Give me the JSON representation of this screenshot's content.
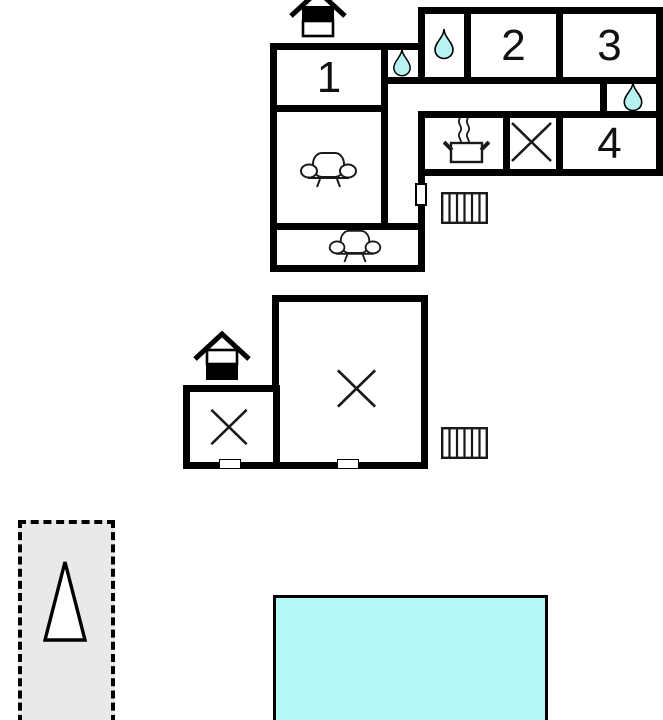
{
  "upper_floor": {
    "room_labels": {
      "r1": "1",
      "r2": "2",
      "r3": "3",
      "r4": "4"
    },
    "icons": [
      "storey-indicator-house-upper",
      "water-drop-icon x3",
      "sofa-icon x2",
      "stove-pot-icon",
      "cross-table-icon",
      "stairs-icon",
      "door-opening"
    ]
  },
  "ground_floor": {
    "icons": [
      "storey-indicator-house-ground",
      "cross-table-icon x2",
      "stairs-icon",
      "door-opening x2"
    ]
  },
  "outdoor": {
    "parking_area": {
      "style": "dashed-rectangle",
      "icon": "tree-triangle-icon"
    },
    "pool": {
      "icon": "swimming-pool"
    }
  },
  "colors": {
    "wall": "#000000",
    "water": "#b7f3f2",
    "pool": "#b5f8f8",
    "area_fill": "#e9e9e9",
    "label": "#111111"
  }
}
